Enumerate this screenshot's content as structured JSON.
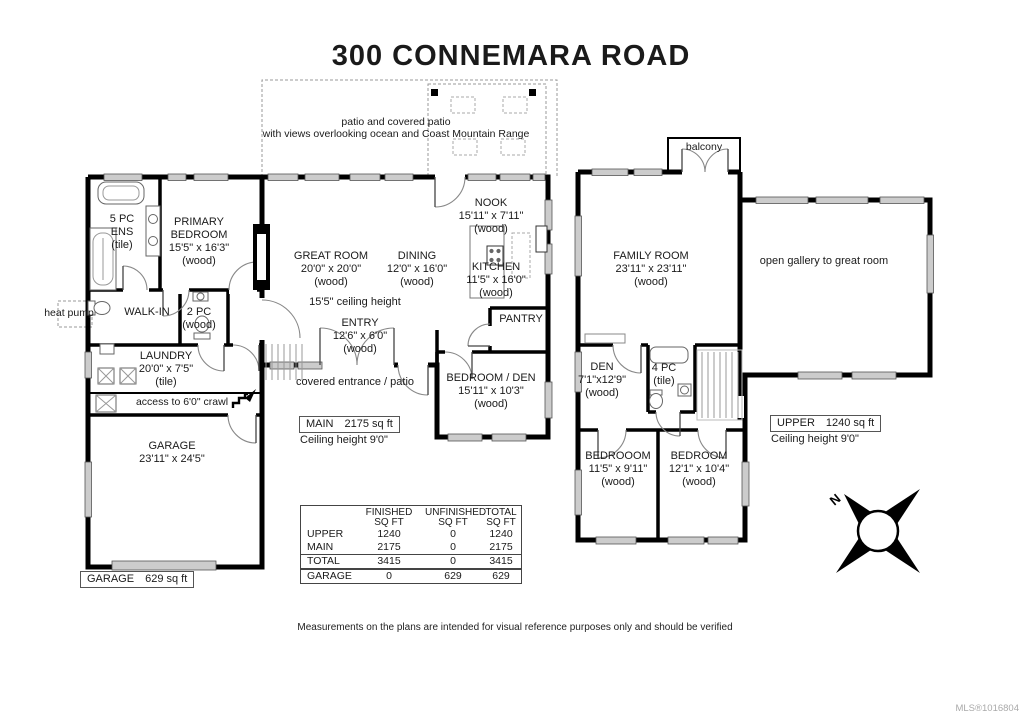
{
  "title": "300 CONNEMARA ROAD",
  "patio": {
    "line1": "patio and covered patio",
    "line2": "with views overlooking ocean and Coast Mountain Range"
  },
  "balcony": {
    "label": "balcony"
  },
  "main_floor": {
    "ens": {
      "l1": "5 PC",
      "l2": "ENS",
      "l3": "(tile)"
    },
    "primary": {
      "l1": "PRIMARY",
      "l2": "BEDROOM",
      "dims": "15'5\" x 16'3\"",
      "floor": "(wood)"
    },
    "walk_in": {
      "label": "WALK-IN"
    },
    "wc": {
      "l1": "2 PC",
      "l2": "(wood)"
    },
    "heat_pump": {
      "label": "heat pump"
    },
    "laundry": {
      "name": "LAUNDRY",
      "dims": "20'0\" x 7'5\"",
      "floor": "(tile)"
    },
    "crawl": {
      "label": "access to 6'0\" crawl"
    },
    "garage": {
      "name": "GARAGE",
      "dims": "23'11\" x 24'5\""
    },
    "great_room": {
      "name": "GREAT ROOM",
      "dims": "20'0\" x 20'0\"",
      "floor": "(wood)"
    },
    "ceiling_note": "15'5\" ceiling height",
    "dining": {
      "name": "DINING",
      "dims": "12'0\" x 16'0\"",
      "floor": "(wood)"
    },
    "kitchen": {
      "name": "KITCHEN",
      "dims": "11'5\" x 16'0\"",
      "floor": "(wood)"
    },
    "nook": {
      "name": "NOOK",
      "dims": "15'11\" x 7'11\"",
      "floor": "(wood)"
    },
    "entry": {
      "name": "ENTRY",
      "dims": "12'6\" x 6'0\"",
      "floor": "(wood)"
    },
    "pantry": {
      "label": "PANTRY"
    },
    "covered_entrance": "covered entrance / patio",
    "bedroom_den": {
      "name": "BEDROOM / DEN",
      "dims": "15'11\" x 10'3\"",
      "floor": "(wood)"
    },
    "area_box": {
      "name": "MAIN",
      "value": "2175 sq ft"
    },
    "ceiling_height": "Ceiling height 9'0\""
  },
  "upper_floor": {
    "family_room": {
      "name": "FAMILY ROOM",
      "dims": "23'11\" x 23'11\"",
      "floor": "(wood)"
    },
    "gallery": "open gallery to great room",
    "den": {
      "name": "DEN",
      "dims": "7'1\"x12'9\"",
      "floor": "(wood)"
    },
    "bath": {
      "l1": "4 PC",
      "l2": "(tile)"
    },
    "bedroom_a": {
      "name": "BEDROOOM",
      "dims": "11'5\" x 9'11\"",
      "floor": "(wood)"
    },
    "bedroom_b": {
      "name": "BEDROOM",
      "dims": "12'1\" x 10'4\"",
      "floor": "(wood)"
    },
    "area_box": {
      "name": "UPPER",
      "value": "1240 sq ft"
    },
    "ceiling_height": "Ceiling height 9'0\""
  },
  "garage_box": {
    "name": "GARAGE",
    "value": "629 sq ft"
  },
  "sqft_table": {
    "headers": {
      "finished": [
        "FINISHED",
        "SQ FT"
      ],
      "unfinished": [
        "UNFINISHED",
        "SQ FT"
      ],
      "total": [
        "TOTAL",
        "SQ FT"
      ]
    },
    "rows": [
      {
        "label": "UPPER",
        "finished": "1240",
        "unfinished": "0",
        "total": "1240"
      },
      {
        "label": "MAIN",
        "finished": "2175",
        "unfinished": "0",
        "total": "2175"
      },
      {
        "label": "TOTAL",
        "finished": "3415",
        "unfinished": "0",
        "total": "3415"
      }
    ],
    "garage_row": {
      "label": "GARAGE",
      "finished": "0",
      "unfinished": "629",
      "total": "629"
    }
  },
  "disclaimer": "Measurements on the plans are intended for visual reference purposes only and should be verified",
  "watermark": "MLS®1016804",
  "compass": {
    "north": "N"
  }
}
